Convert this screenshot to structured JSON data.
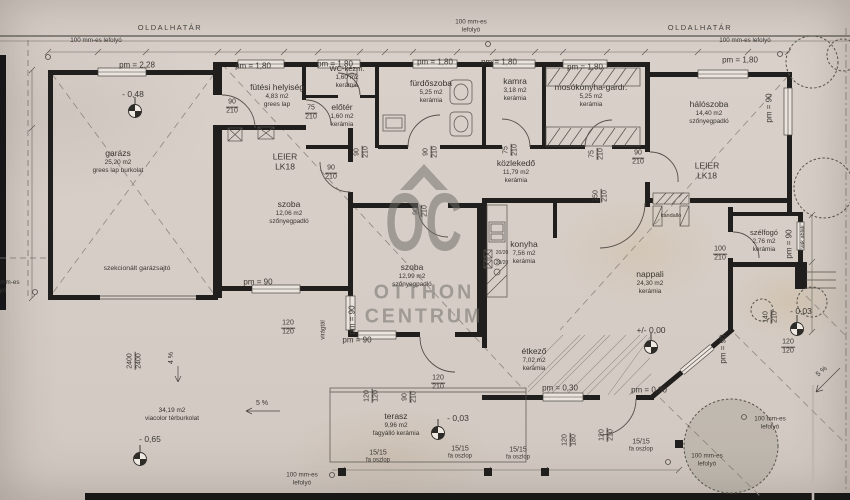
{
  "site": {
    "boundary_label": "OLDALHATÁR",
    "drain_full": "100 mm-es lefolyó",
    "drain_line1": "100 mm-es",
    "drain_line2": "lefolyó",
    "garage_door_label": "szekcionált garázsajtó",
    "slope_4": "4 %",
    "slope_5": "5 %",
    "flower_box": "virágtál",
    "blind_window": "vak ablak"
  },
  "rooms": {
    "garazs": {
      "name": "garázs",
      "area": "25,20 m2",
      "floor": "grees lap burkolat"
    },
    "futesi": {
      "name": "fütési helyiség",
      "area": "4,83 m2",
      "floor": "grees lap"
    },
    "wc": {
      "name": "WC-kézm.",
      "area": "1,60 m2",
      "floor": "kerámia"
    },
    "eloter": {
      "name": "előtér",
      "area": "1,60 m2",
      "floor": "kerámia"
    },
    "furdoszoba": {
      "name": "fürdőszoba",
      "area": "5,25 m2",
      "floor": "kerámia"
    },
    "kamra": {
      "name": "kamra",
      "area": "3,18 m2",
      "floor": "kerámia"
    },
    "mosokonyha": {
      "name": "mosókonyha-gardr.",
      "area": "5,25 m2",
      "floor": "kerámia"
    },
    "haloszoba": {
      "name": "hálószoba",
      "area": "14,40 m2",
      "floor": "szőnyegpadló"
    },
    "szoba1": {
      "name": "szoba",
      "area": "12,06 m2",
      "floor": "szőnyegpadló"
    },
    "kozlekedo": {
      "name": "közlekedő",
      "area": "11,79 m2",
      "floor": "kerámia"
    },
    "szoba2": {
      "name": "szoba",
      "area": "12,99 m2",
      "floor": "szőnyegpadló"
    },
    "konyha": {
      "name": "konyha",
      "area": "7,56 m2",
      "floor": "kerámia"
    },
    "nappali": {
      "name": "nappali",
      "area": "24,30 m2",
      "floor": "kerámia"
    },
    "szelfogo": {
      "name": "szélfogó",
      "area": "2,76 m2",
      "floor": "kerámia"
    },
    "etkezo": {
      "name": "étkező",
      "area": "7,02 m2",
      "floor": "kerámia"
    },
    "terasz": {
      "name": "terasz",
      "area": "9,96 m2",
      "floor": "fagyálló kerámia"
    },
    "udvar": {
      "area": "34,19 m2",
      "floor": "viacolor térburkolat"
    }
  },
  "levels": {
    "garazs": "- 0,48",
    "foldszint": "+/- 0,00",
    "terasz": "- 0,03",
    "bejarat": "- 0,03",
    "udvar": "- 0,65"
  },
  "parapets": {
    "pm_228": "pm = 2,28",
    "pm_180": "pm = 1,80",
    "pm_90": "pm = 90",
    "pm_030": "pm = 0,30"
  },
  "dims": {
    "d90": {
      "w": "90",
      "h": "210"
    },
    "d75": {
      "w": "75",
      "h": "210"
    },
    "d100": {
      "w": "100",
      "h": "210"
    },
    "d120": {
      "w": "120",
      "h": "210"
    },
    "d140": {
      "w": "140",
      "h": "210"
    },
    "d150": {
      "w": "150",
      "h": "210"
    },
    "d120_120": {
      "w": "120",
      "h": "120"
    },
    "d120_180": {
      "w": "120",
      "h": "180"
    },
    "d2400": {
      "w": "2400",
      "h": "2400"
    },
    "post_size": "15/15",
    "post_type": "fa oszlop",
    "pillar": "20/20"
  },
  "notes": {
    "leier": "LEIER",
    "leier_type": "LK18",
    "kandallo": "kandalló"
  },
  "watermark": {
    "initials": "OC",
    "line1": "OTTHON",
    "line2": "CENTRUM"
  }
}
